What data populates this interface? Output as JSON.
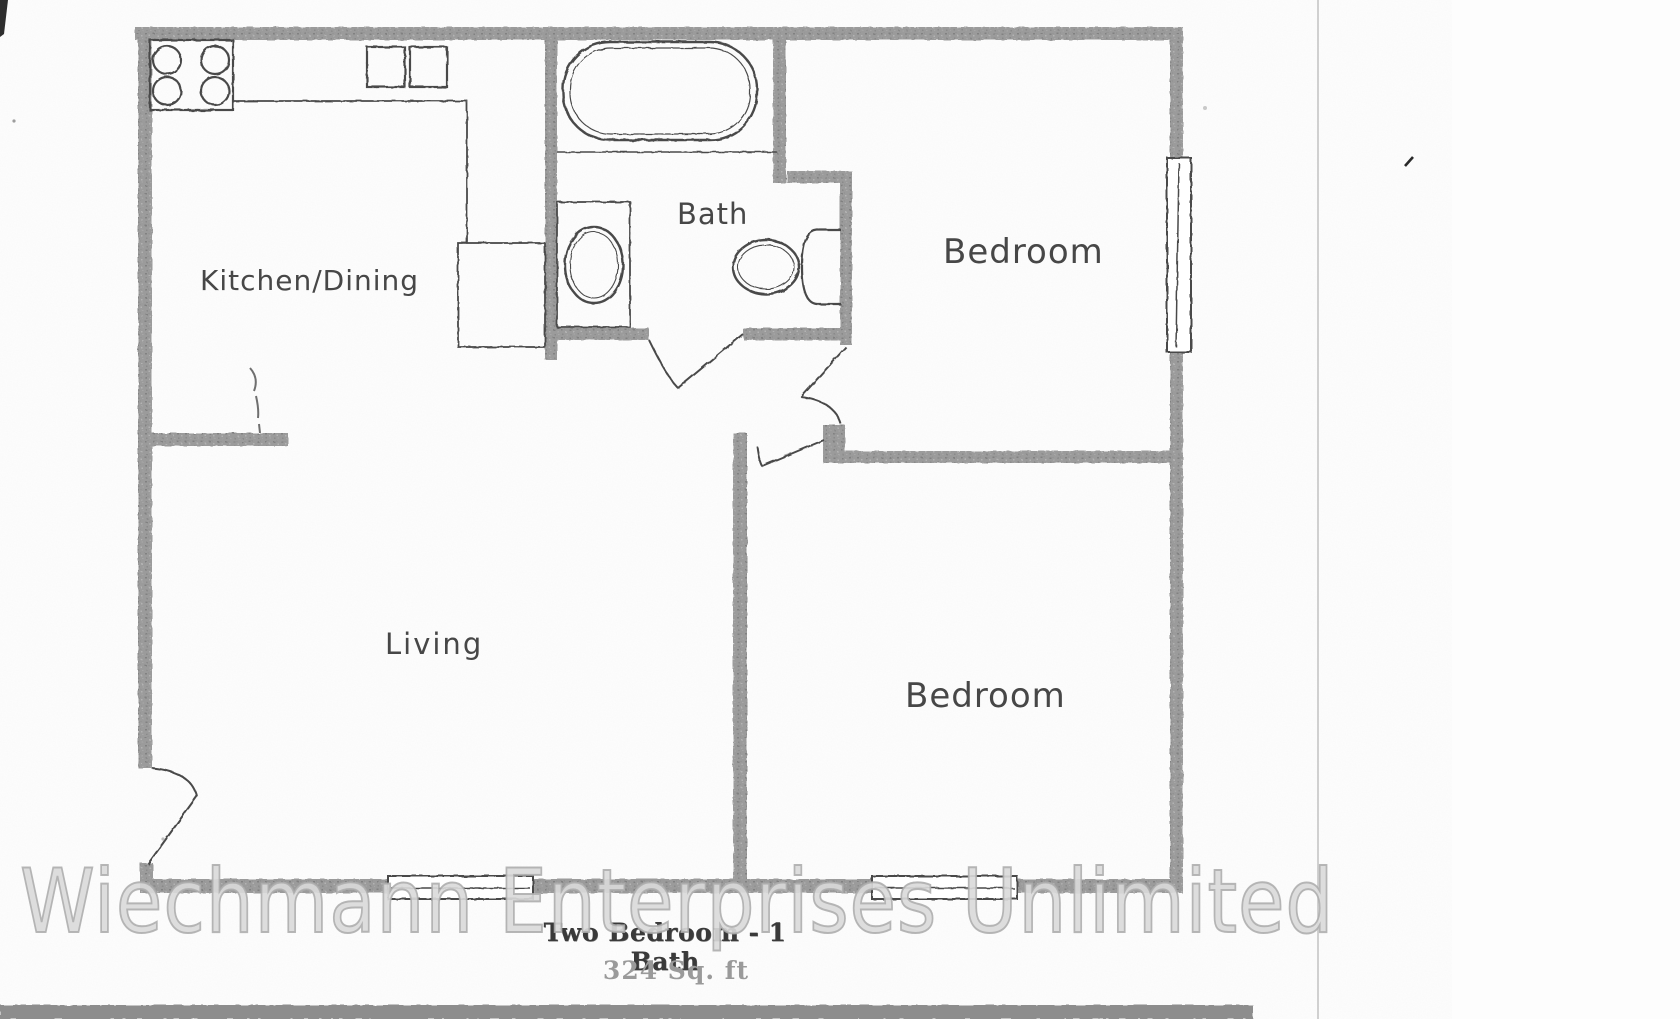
{
  "document": {
    "title": "Two Bedroom - 1 Bath",
    "area_label": "324 Sq. ft",
    "watermark_text": "Wiechmann Enterprises Unlimited"
  },
  "floor_plan": {
    "rooms": [
      {
        "name": "Kitchen/Dining"
      },
      {
        "name": "Bath"
      },
      {
        "name": "Bedroom"
      },
      {
        "name": "Living"
      },
      {
        "name": "Bedroom"
      }
    ],
    "fixtures": [
      {
        "icon": "stove-icon"
      },
      {
        "icon": "kitchen-sink-icon"
      },
      {
        "icon": "refrigerator-icon"
      },
      {
        "icon": "bathtub-icon"
      },
      {
        "icon": "vanity-sink-icon"
      },
      {
        "icon": "toilet-icon"
      },
      {
        "icon": "window-icon"
      },
      {
        "icon": "door-swing-icon"
      }
    ],
    "colors": {
      "wall": "#989898",
      "fixture_line": "#4a4a4a",
      "room_label": "#474747",
      "title_text": "#3a3a3a",
      "area_text": "#9a9a9a",
      "watermark_outline": "#acacac",
      "scan_band": "#8d8d8d",
      "page_edge_line": "#c2c2c2"
    }
  }
}
